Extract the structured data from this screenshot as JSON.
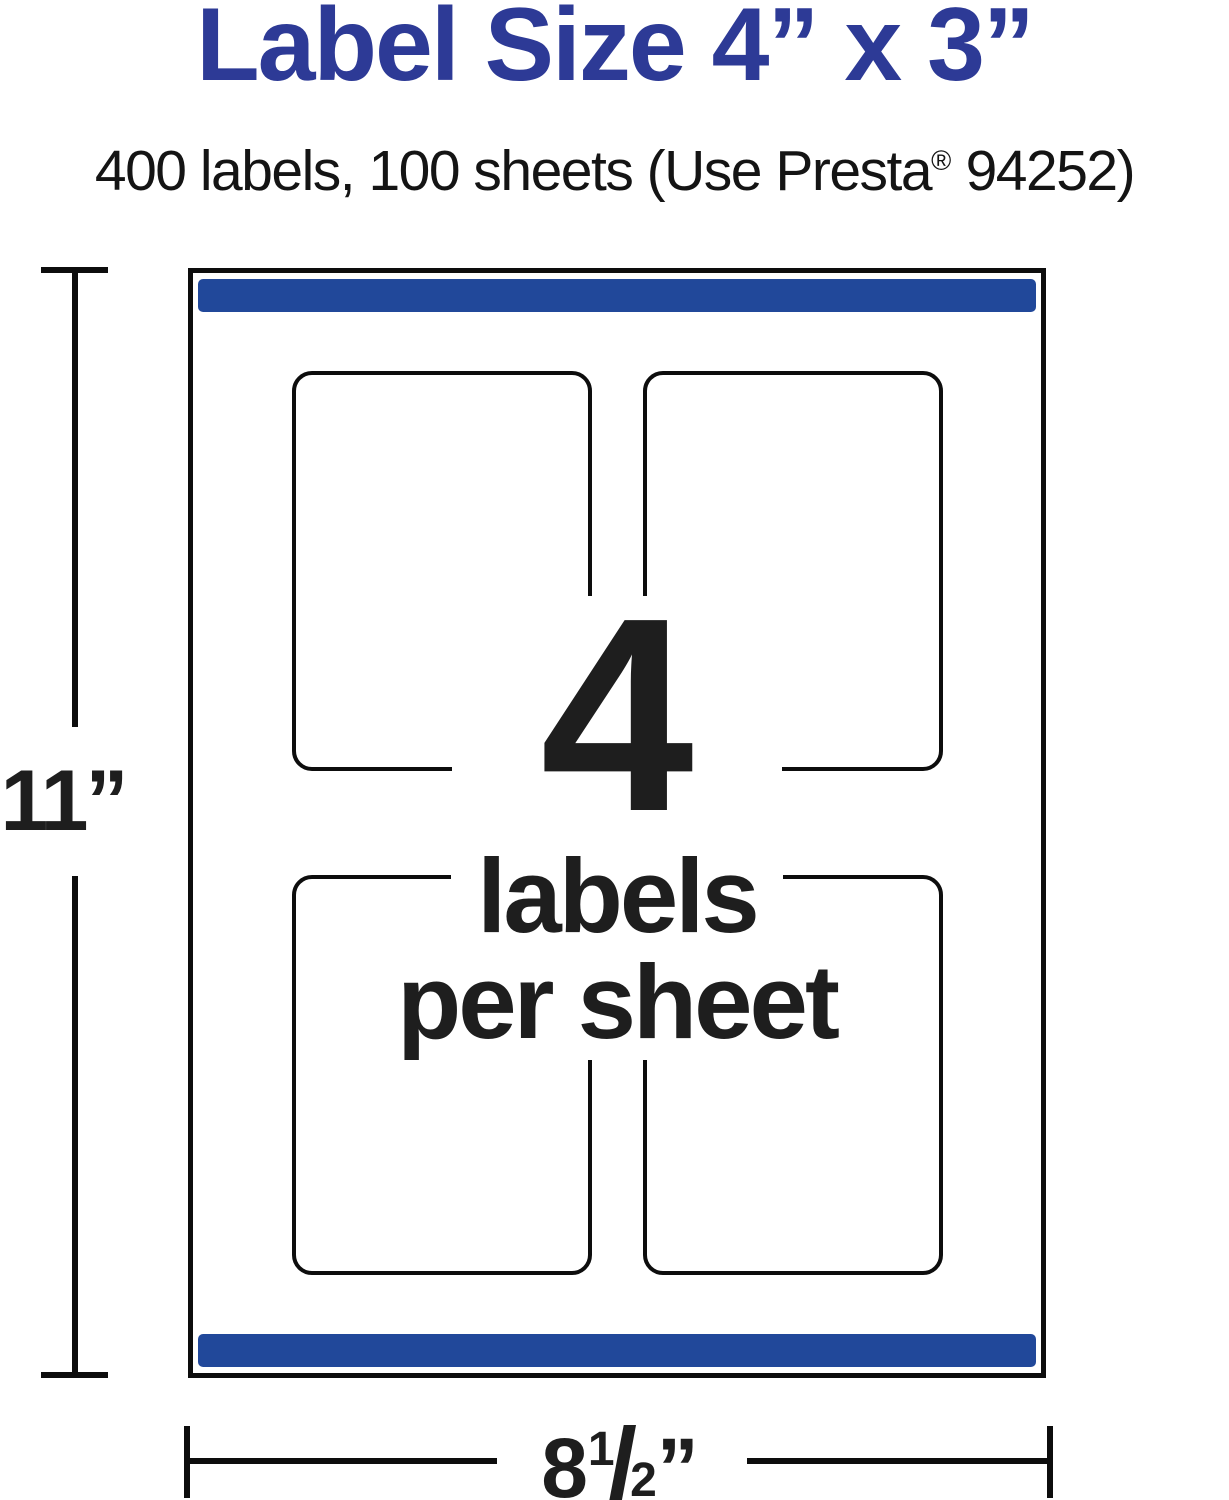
{
  "page": {
    "title": "Label Size 4” x 3”",
    "subtitle": {
      "pre": "400 labels, 100 sheets (Use Presta",
      "registered_mark": "®",
      "post": " 94252)"
    }
  },
  "sheet": {
    "labels_count": "4",
    "labels_word": "labels",
    "per_sheet_words": "per sheet",
    "label_cells": 4
  },
  "dimensions": {
    "height_label": "11”",
    "width": {
      "whole": "8",
      "fraction_numerator": "1",
      "fraction_slash": "/",
      "fraction_denominator": "2",
      "unit_mark": "”"
    }
  },
  "colors": {
    "accent_blue": "#21489A",
    "title_blue": "#2D3A96",
    "ink": "#1E1E1E",
    "line_black": "#0D0D0D"
  }
}
